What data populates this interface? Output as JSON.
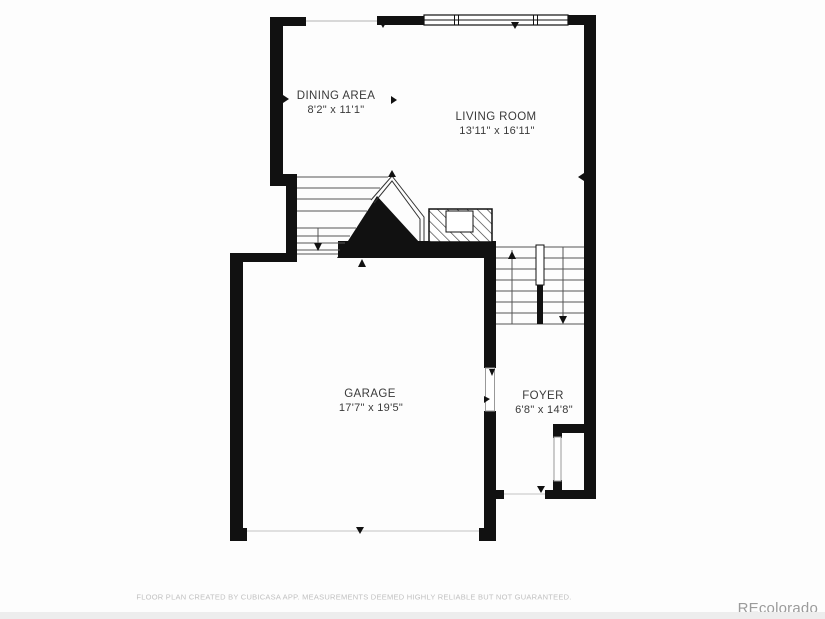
{
  "rooms": {
    "dining": {
      "name": "DINING AREA",
      "dims": "8'2\" x 11'1\""
    },
    "living": {
      "name": "LIVING ROOM",
      "dims": "13'11\" x 16'11\""
    },
    "garage": {
      "name": "GARAGE",
      "dims": "17'7\" x 19'5\""
    },
    "foyer": {
      "name": "FOYER",
      "dims": "6'8\" x 14'8\""
    }
  },
  "footer": {
    "disclaimer": "FLOOR PLAN CREATED BY CUBICASA APP. MEASUREMENTS DEEMED HIGHLY RELIABLE BUT NOT GUARANTEED."
  },
  "watermark": "REcolorado",
  "colors": {
    "wall": "#111111",
    "stair_line": "#555555",
    "opening_line": "#cccccc",
    "label_text": "#3a3a3a",
    "muted_text": "#c0c0c0",
    "watermark_text": "#9b9b9b"
  }
}
